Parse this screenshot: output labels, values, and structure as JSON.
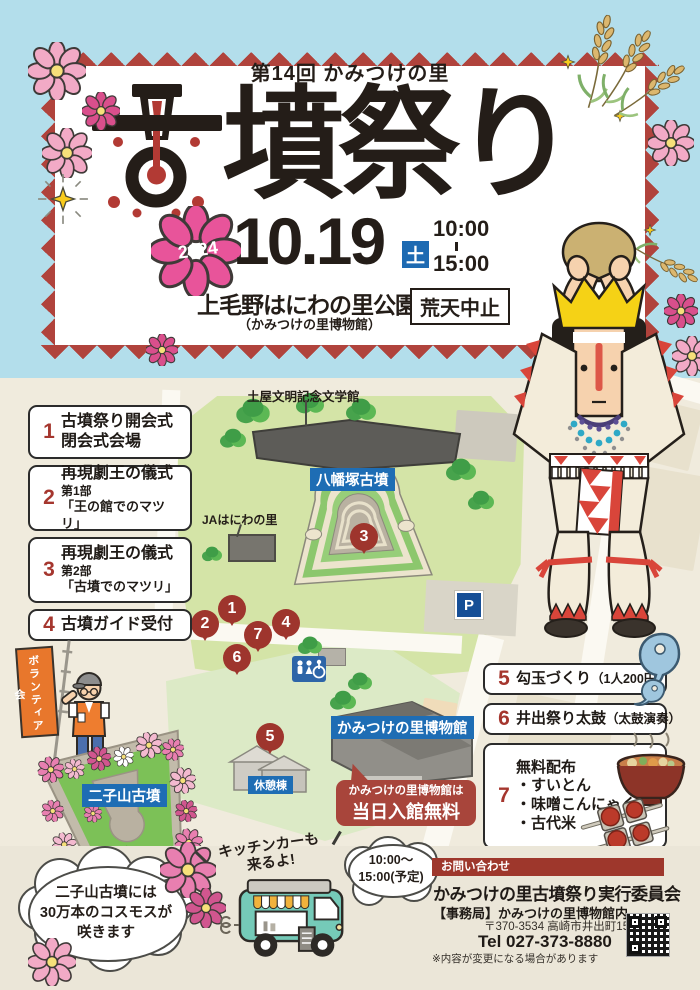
{
  "title": {
    "edition": "第14回 かみつけの里",
    "main_first_char": "古",
    "main_rest": "墳祭り"
  },
  "event": {
    "year": "2024",
    "date": "10.19",
    "weekday": "土",
    "time_start": "10:00",
    "time_end": "15:00",
    "venue": "上毛野はにわの里公園",
    "venue_note": "（かみつけの里博物館）",
    "weather_note": "荒天中止"
  },
  "legend": {
    "items_left": [
      {
        "num": "1",
        "line1": "古墳祭り開会式",
        "line2": "閉会式会場"
      },
      {
        "num": "2",
        "line1": "再現劇王の儀式",
        "line2": "第1部",
        "line3": "「王の館でのマツリ」"
      },
      {
        "num": "3",
        "line1": "再現劇王の儀式",
        "line2": "第2部",
        "line3": "「古墳でのマツリ」"
      },
      {
        "num": "4",
        "line1": "古墳ガイド受付"
      }
    ],
    "items_right": [
      {
        "num": "5",
        "line1": "勾玉づくり",
        "paren": "（1人200円）"
      },
      {
        "num": "6",
        "line1": "井出祭り太鼓",
        "paren": "（太鼓演奏）"
      },
      {
        "num": "7",
        "line1": "無料配布",
        "line2": "・すいとん",
        "line3": "・味噌こんにゃく",
        "line4": "・古代米"
      }
    ]
  },
  "map": {
    "pins": [
      "1",
      "2",
      "3",
      "4",
      "5",
      "6",
      "7"
    ],
    "labels": {
      "literature_museum": "土屋文明記念文学館",
      "yawatazuka_kofun": "八幡塚古墳",
      "ja_hall": "JAはにわの里",
      "parking": "P",
      "museum": "かみつけの里博物館",
      "rest_house": "休憩棟",
      "futagoyama_kofun": "二子山古墳"
    },
    "free_admission": {
      "line1": "かみつけの里博物館は",
      "line2": "当日入館無料"
    },
    "volunteer_flag": "ボランティア会"
  },
  "footer": {
    "cosmos_bubble": {
      "line1": "二子山古墳には",
      "line2": "30万本のコスモスが",
      "line3": "咲きます"
    },
    "kitchen_car": {
      "note_line1": "キッチンカーも",
      "note_line2": "来るよ!",
      "time_line1": "10:00～",
      "time_line2": "15:00(予定)"
    },
    "contact": {
      "header": "お問い合わせ",
      "organization": "かみつけの里古墳祭り実行委員会",
      "office": "【事務局】かみつけの里博物館内",
      "address": "〒370-3534 高崎市井出町1514",
      "tel": "Tel 027-373-8880",
      "disclaimer": "※内容が変更になる場合があります"
    }
  },
  "colors": {
    "sky_blue": "#b3deeb",
    "zigzag_red": "#b0433c",
    "pin_red": "#9e352d",
    "label_blue": "#1e6db4",
    "highlight_pink": "#e8549a",
    "weekday_blue": "#1d6ab2",
    "callout_red": "#a8453b"
  }
}
